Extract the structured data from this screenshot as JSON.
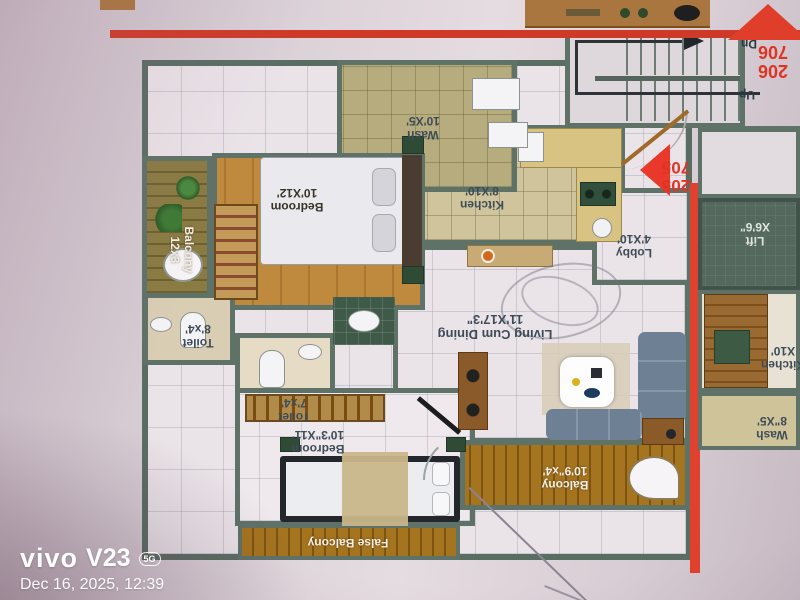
{
  "plan": {
    "rooms": {
      "wash": {
        "name": "Wash",
        "size": "10'X5'"
      },
      "kitchen": {
        "name": "Kitchen",
        "size": "8'X10'"
      },
      "lobby": {
        "name": "Lobby",
        "size": "4'X10'"
      },
      "living": {
        "name": "Living Cum Dining",
        "size": "11'X17'3\""
      },
      "balcony_side": {
        "name": "Balcony",
        "size": "12x3"
      },
      "bedroom_master": {
        "name": "Bedroom",
        "size": "10'X12'"
      },
      "toilet_a": {
        "name": "Toilet",
        "size": "8'x4'"
      },
      "toilet_b": {
        "name": "Toilet",
        "size": "7'x4'"
      },
      "bedroom_second": {
        "name": "Bedroom",
        "size": "10'3\"X11'"
      },
      "false_balcony": {
        "name": "False Balcony"
      },
      "balcony_front": {
        "name": "Balcony",
        "size": "10'9\"x4'"
      }
    },
    "stairs": {
      "up": "Up",
      "down": "Dn"
    },
    "flat_numbers": {
      "entrance": {
        "line1": "205",
        "line2": "705"
      },
      "corner": {
        "line1": "206",
        "line2": "706"
      }
    },
    "adjacent_flat": {
      "lift": {
        "name": "Lift",
        "size": "X6'6\""
      },
      "kitchen": {
        "name": "Kitchen",
        "size": "X10'"
      },
      "wash": {
        "name": "Wash",
        "size": "8\"X5'"
      }
    },
    "colors": {
      "accent_red": "#df3424",
      "wall": "#5f7268",
      "wood": "#a5741f",
      "lift_green": "#54685e"
    }
  },
  "watermark": {
    "brand": "vivo",
    "model": "V23",
    "badge": "5G",
    "timestamp": "Dec 16, 2025, 12:39"
  }
}
